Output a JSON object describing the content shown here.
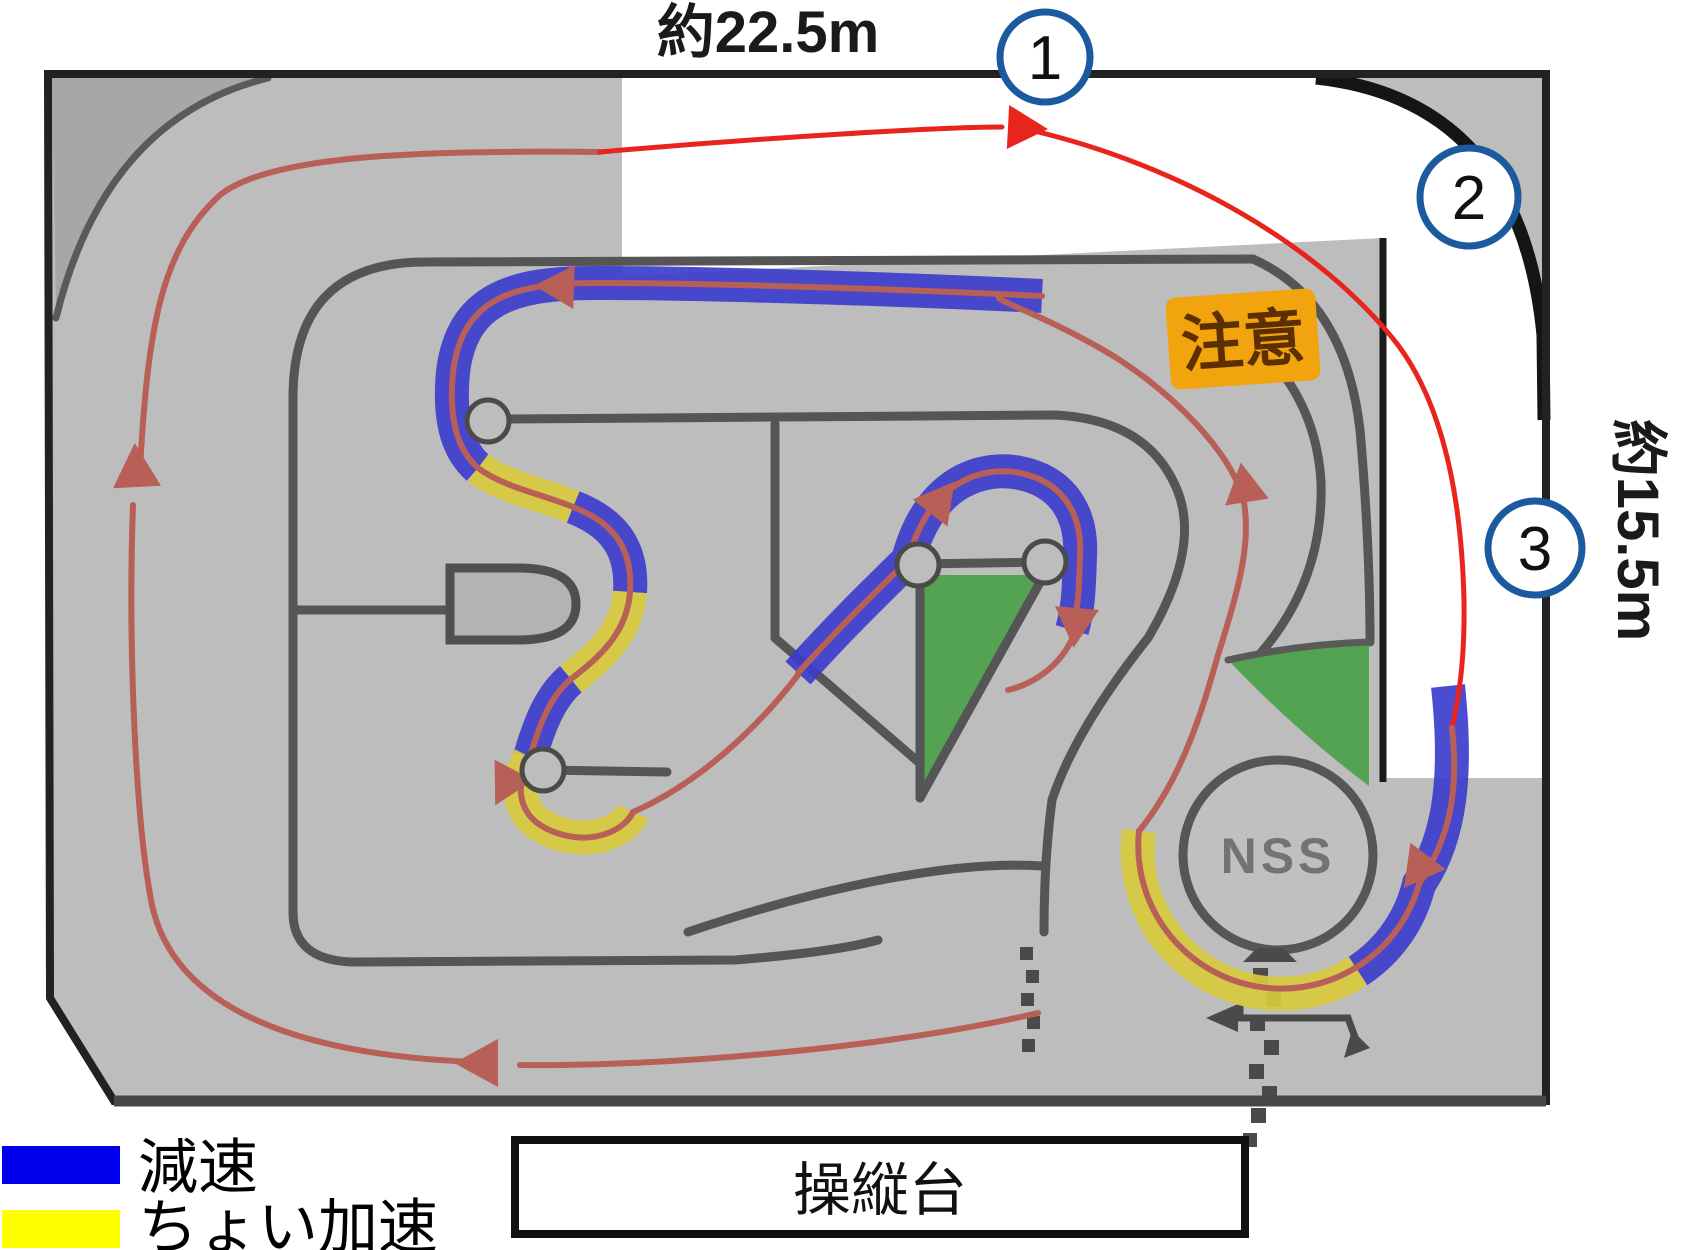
{
  "dimensions": {
    "top": "約22.5m",
    "right": "約15.5m"
  },
  "markers": [
    {
      "label": "1"
    },
    {
      "label": "2"
    },
    {
      "label": "3"
    }
  ],
  "caution": {
    "label": "注意",
    "bg_color": "#F2A40E",
    "text_color": "#5C2E00"
  },
  "nss": {
    "label": "NSS"
  },
  "platform": {
    "label": "操縦台"
  },
  "legend": {
    "items": [
      {
        "label": "減速",
        "color": "#0000EE",
        "meaning": "decelerate zone"
      },
      {
        "label": "ちょい加速",
        "color": "#FFFF00",
        "meaning": "slight acceleration zone"
      }
    ]
  },
  "colors": {
    "course_floor": "#BDBDBD",
    "corner_shade": "#A7A7A7",
    "walls": "#555555",
    "outer_border": "#222222",
    "route_outer_red": "#E8251C",
    "route_inner_red": "#B85F58",
    "decel_band_blue": "#3D3DCC",
    "accel_band_yellow": "#D8CA3E",
    "green_zone": "#53A353",
    "marker_ring_blue": "#1B5A9E"
  }
}
